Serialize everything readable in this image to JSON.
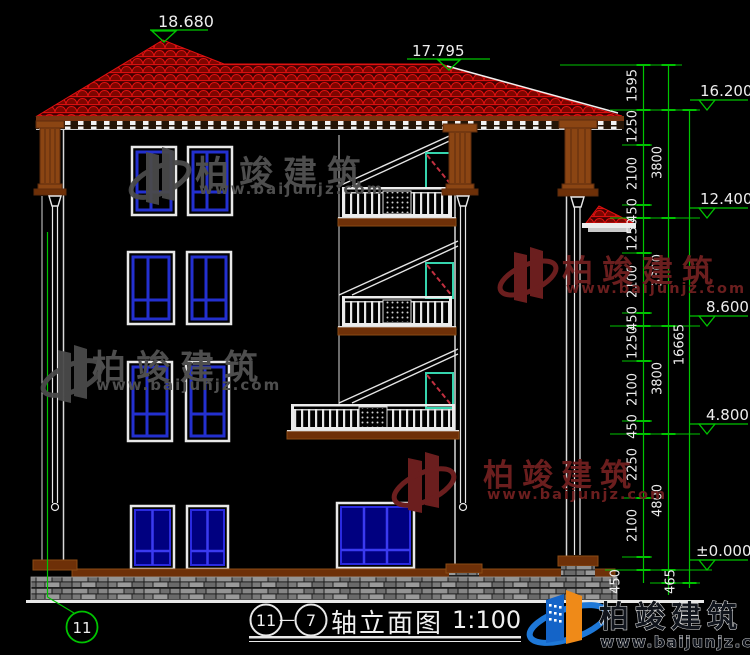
{
  "marks": {
    "peak": "18.680",
    "eave": "17.795"
  },
  "elev": {
    "m16": "16.200",
    "m12": "12.400",
    "m8": "8.600",
    "m4": "4.800",
    "m0": "±0.000"
  },
  "d1": {
    "s0": "1595",
    "s1": "1250",
    "s2": "2100",
    "s3": "450",
    "s4": "1250",
    "s5": "2100",
    "s6": "450",
    "s7": "1250",
    "s8": "2100",
    "s9": "450",
    "s10": "2250",
    "s11": "2100",
    "s12": "450"
  },
  "d2": {
    "f0": "3800",
    "f1": "3800",
    "f2": "3800",
    "f3": "4800",
    "f4": "465"
  },
  "dtotal": "16665",
  "axis": {
    "bubble": "11"
  },
  "title": {
    "a": "11",
    "dash": "—",
    "b": "7",
    "name": "轴立面图",
    "scale": "1:100"
  },
  "brand": {
    "name": "柏竣建筑",
    "url": "www.baijunjz.com"
  },
  "colors": {
    "roof_red": "#e01010",
    "dim_green": "#00c400",
    "window_blue": "#2330cf",
    "door_teal": "#35d4ae",
    "wood_brown": "#8b4513",
    "logo_blue": "#1464c8",
    "logo_orange": "#ef8a18"
  }
}
